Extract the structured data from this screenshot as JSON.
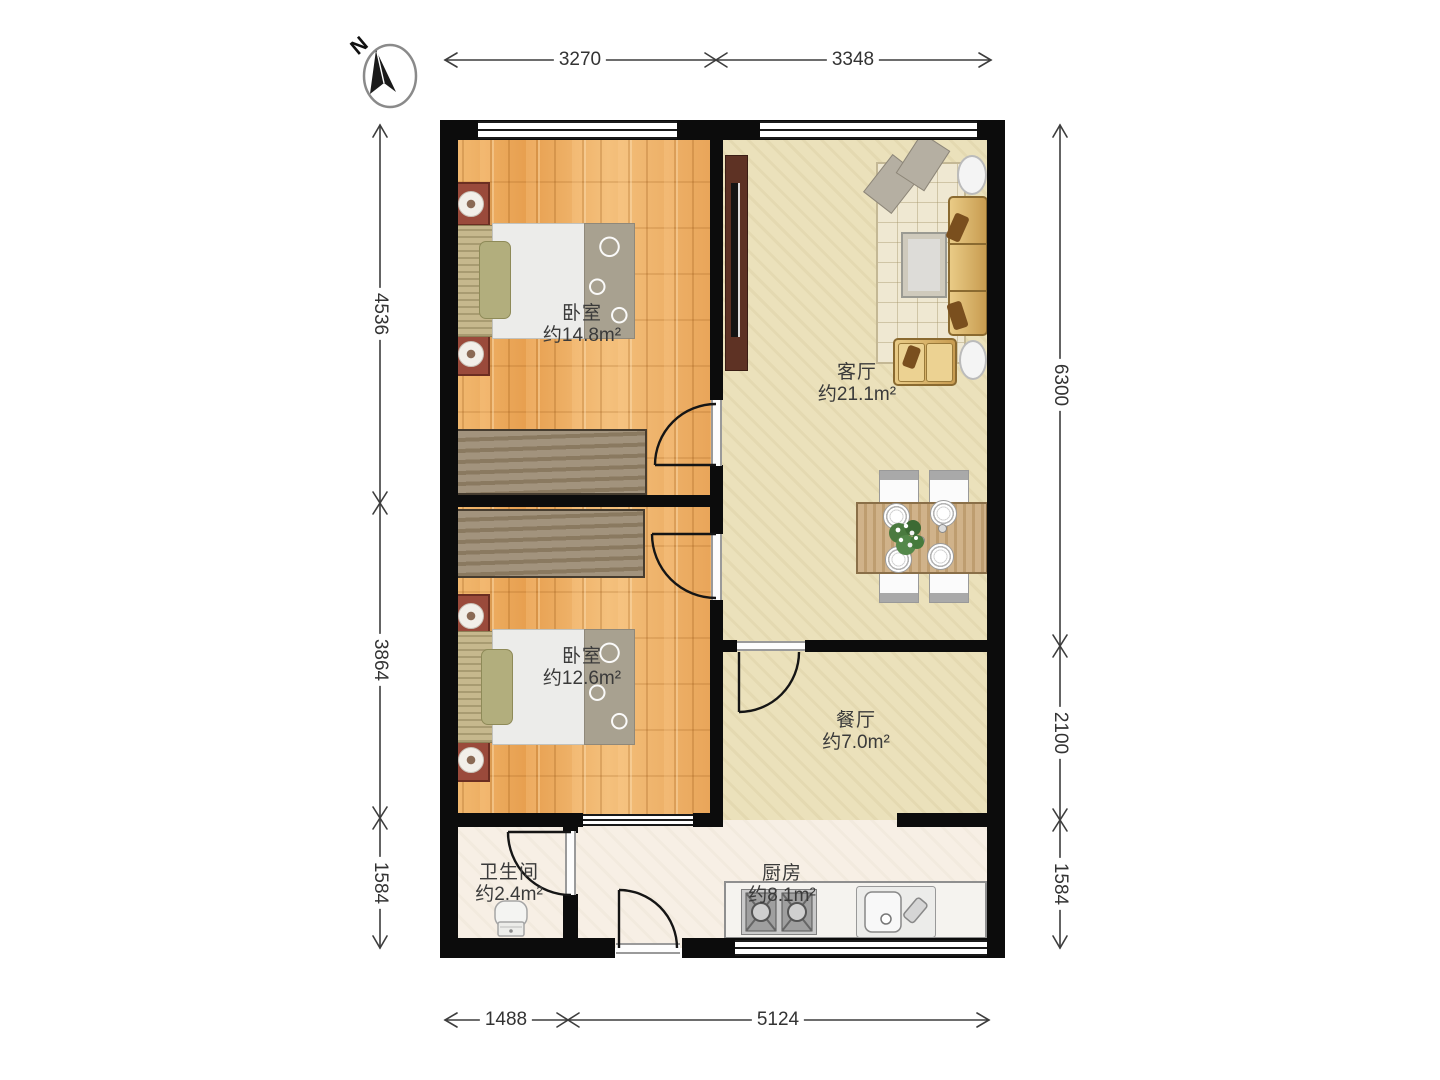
{
  "compass": {
    "label": "N"
  },
  "rooms": {
    "bedroom1": {
      "name": "卧室",
      "area": "约14.8m²"
    },
    "bedroom2": {
      "name": "卧室",
      "area": "约12.6m²"
    },
    "living": {
      "name": "客厅",
      "area": "约21.1m²"
    },
    "dining": {
      "name": "餐厅",
      "area": "约7.0m²"
    },
    "bathroom": {
      "name": "卫生间",
      "area": "约2.4m²"
    },
    "kitchen": {
      "name": "厨房",
      "area": "约8.1m²"
    }
  },
  "dimensions": {
    "top": [
      "3270",
      "3348"
    ],
    "left": [
      "4536",
      "3864",
      "1584"
    ],
    "right": [
      "6300",
      "2100",
      "1584"
    ],
    "bottom": [
      "1488",
      "5124"
    ]
  },
  "colors": {
    "wall": "#0c0c0c",
    "wood_floor": "#edaa5f",
    "living_floor": "#ebe1bb",
    "service_floor": "#f7efe5",
    "dim_line": "#3d3d3d",
    "label_text": "#333333"
  }
}
